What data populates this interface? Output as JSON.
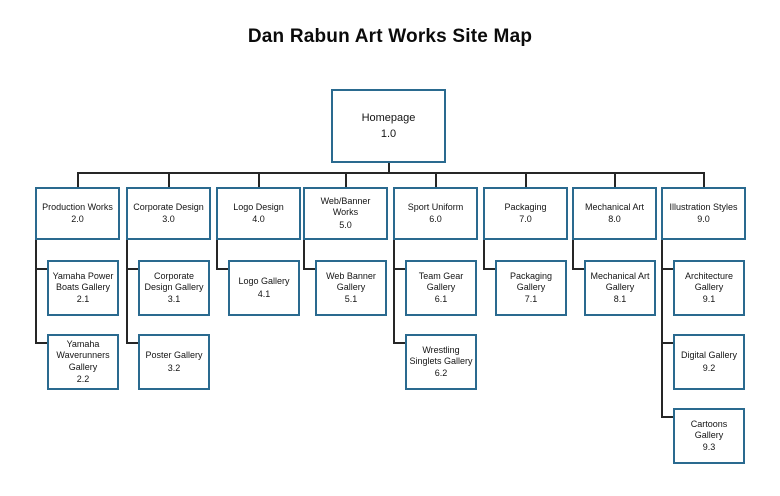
{
  "title": "Dan Rabun Art Works Site Map",
  "colors": {
    "box_border": "#2a6a8f",
    "connector": "#262626",
    "background": "#ffffff",
    "text": "#141414"
  },
  "sitemap": {
    "root": {
      "label": "Homepage",
      "num": "1.0"
    },
    "sections": [
      {
        "label": "Production Works",
        "num": "2.0",
        "children": [
          {
            "label": "Yamaha Power Boats Gallery",
            "num": "2.1"
          },
          {
            "label": "Yamaha Waverunners Gallery",
            "num": "2.2"
          }
        ]
      },
      {
        "label": "Corporate Design",
        "num": "3.0",
        "children": [
          {
            "label": "Corporate Design Gallery",
            "num": "3.1"
          },
          {
            "label": "Poster Gallery",
            "num": "3.2"
          }
        ]
      },
      {
        "label": "Logo Design",
        "num": "4.0",
        "children": [
          {
            "label": "Logo Gallery",
            "num": "4.1"
          }
        ]
      },
      {
        "label": "Web/Banner Works",
        "num": "5.0",
        "children": [
          {
            "label": "Web Banner Gallery",
            "num": "5.1"
          }
        ]
      },
      {
        "label": "Sport Uniform",
        "num": "6.0",
        "children": [
          {
            "label": "Team Gear Gallery",
            "num": "6.1"
          },
          {
            "label": "Wrestling Singlets Gallery",
            "num": "6.2"
          }
        ]
      },
      {
        "label": "Packaging",
        "num": "7.0",
        "children": [
          {
            "label": "Packaging Gallery",
            "num": "7.1"
          }
        ]
      },
      {
        "label": "Mechanical Art",
        "num": "8.0",
        "children": [
          {
            "label": "Mechanical Art Gallery",
            "num": "8.1"
          }
        ]
      },
      {
        "label": "Illustration Styles",
        "num": "9.0",
        "children": [
          {
            "label": "Architecture Gallery",
            "num": "9.1"
          },
          {
            "label": "Digital Gallery",
            "num": "9.2"
          },
          {
            "label": "Cartoons Gallery",
            "num": "9.3"
          }
        ]
      }
    ]
  }
}
